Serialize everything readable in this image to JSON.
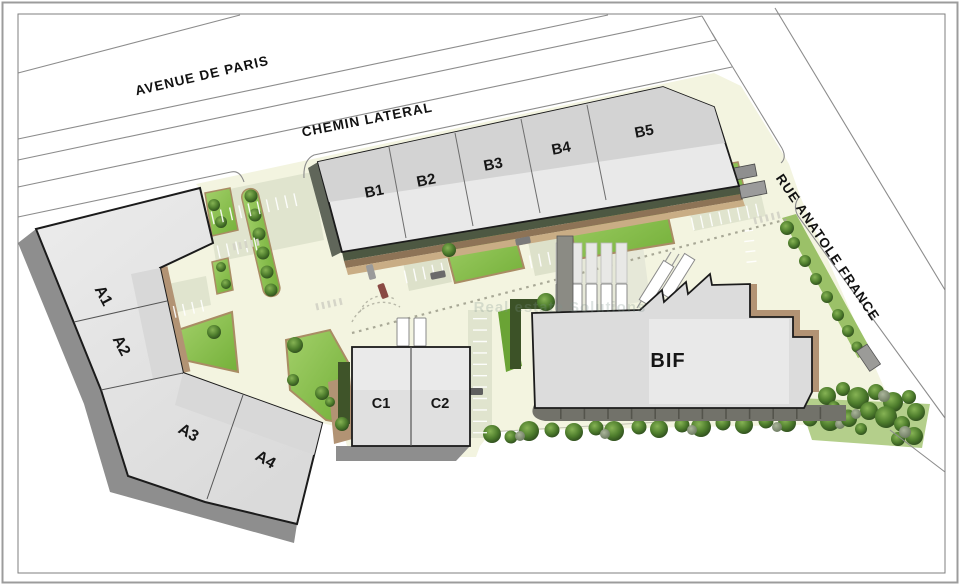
{
  "plan": {
    "type": "site-plan",
    "streets": {
      "avenue": "AVENUE DE PARIS",
      "chemin": "CHEMIN LATERAL",
      "rue": "RUE ANATOLE FRANCE"
    },
    "buildings": {
      "a": {
        "units": [
          "A1",
          "A2",
          "A3",
          "A4"
        ]
      },
      "b": {
        "units": [
          "B1",
          "B2",
          "B3",
          "B4",
          "B5"
        ]
      },
      "c": {
        "units": [
          "C1",
          "C2"
        ]
      },
      "bif": {
        "label": "BIF"
      }
    },
    "watermark": "Real estate Solutions",
    "colors": {
      "paving": "#f3f4e0",
      "parking": "#e0e4ce",
      "lawn": "#82bd3f",
      "hedge": "#44522f",
      "mulch": "#a98c64",
      "building_light": "#e9e9e9",
      "building_dark": "#d3d3d3",
      "shadow": "#8e8e8e",
      "outline": "#1b1b1b",
      "road_line": "#8c8c8c"
    }
  }
}
